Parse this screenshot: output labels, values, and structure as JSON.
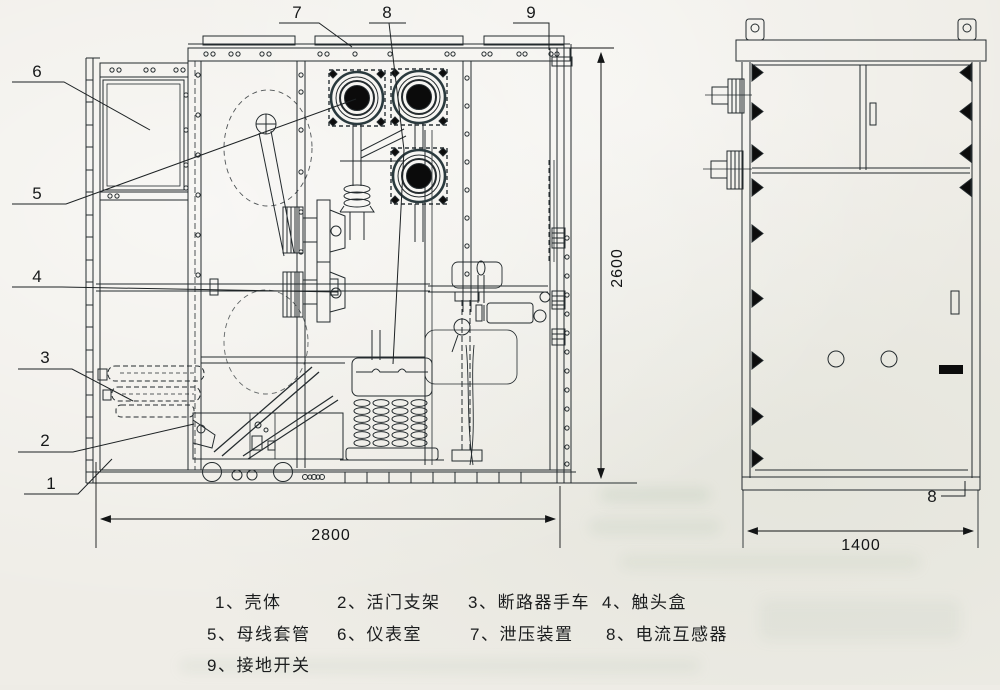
{
  "drawing": {
    "kind": "switchgear-outline-drawing",
    "views": {
      "front_section": "left",
      "side_elevation": "right"
    }
  },
  "callouts": {
    "top": [
      "7",
      "8",
      "9"
    ],
    "left": [
      "6",
      "5",
      "4",
      "3",
      "2",
      "1"
    ],
    "side_bottom": "8"
  },
  "dimensions": {
    "front_width": "2800",
    "front_height": "2600",
    "side_width": "1400"
  },
  "legend": {
    "items": [
      "1、壳体",
      "2、活门支架",
      "3、断路器手车",
      "4、触头盒",
      "5、母线套管",
      "6、仪表室",
      "7、泄压装置",
      "8、电流互感器",
      "9、接地开关"
    ]
  },
  "colors": {
    "line": "#242b2e",
    "ink": "#0c0c0c",
    "paper": "#efede7"
  }
}
